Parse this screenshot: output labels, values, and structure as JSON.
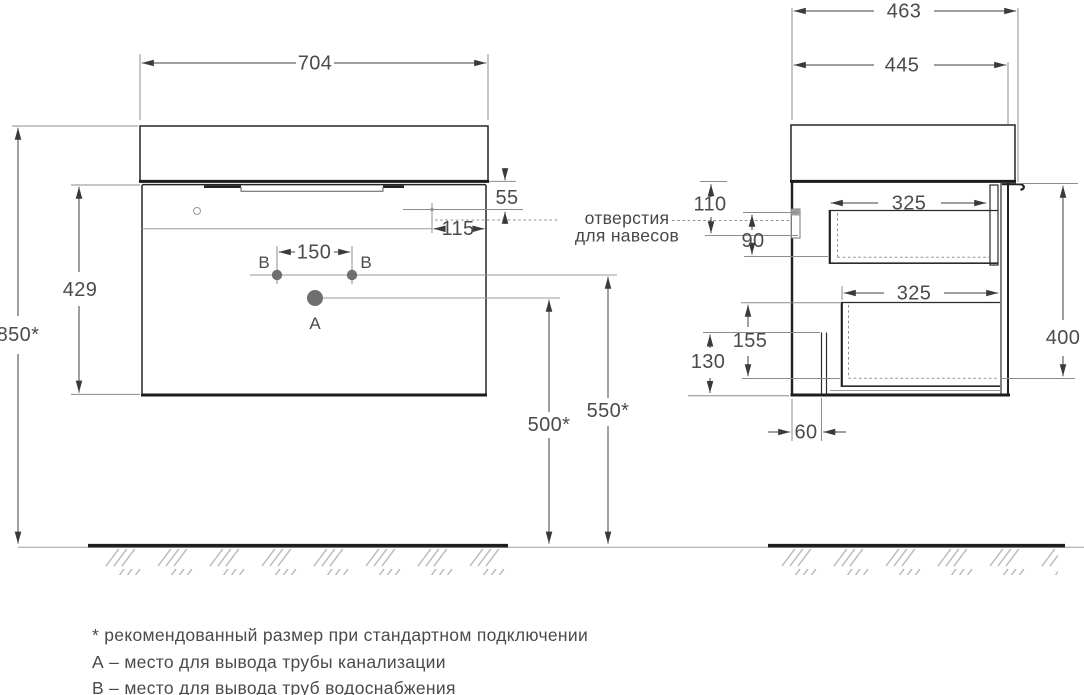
{
  "front_view": {
    "overall_width": "704",
    "mount_height": "850*",
    "body_height": "429",
    "hole_below_top": "55",
    "hole_from_edge": "115",
    "water_holes_spacing": "150",
    "drain_height": "500*",
    "water_height": "550*",
    "drain_label": "A",
    "water_label": "B"
  },
  "side_view": {
    "overall_depth": "463",
    "body_depth": "445",
    "hanger_hole_offset": "110",
    "hanger_bracket_height": "90",
    "top_drawer_inner_depth": "325",
    "bottom_drawer_inner_depth": "325",
    "body_height": "400",
    "drawer_bottom_level": "155",
    "recess_height": "130",
    "recess_depth": "60"
  },
  "annotations": {
    "hanger_note_line1": "отверстия",
    "hanger_note_line2": "для навесов"
  },
  "legend": {
    "note_asterisk": "* рекомендованный размер при стандартном подключении",
    "note_a": "А – место для вывода трубы канализации",
    "note_b": "В – место для вывода труб водоснабжения"
  },
  "colors": {
    "object_line": "#262626",
    "dimension_line": "#3f3f3f",
    "auxiliary_line": "#8c8c8c",
    "text": "#4b4b4b",
    "hatch": "#b3b3b3",
    "hole_fill": "#6f6f6f",
    "background": "#ffffff"
  }
}
